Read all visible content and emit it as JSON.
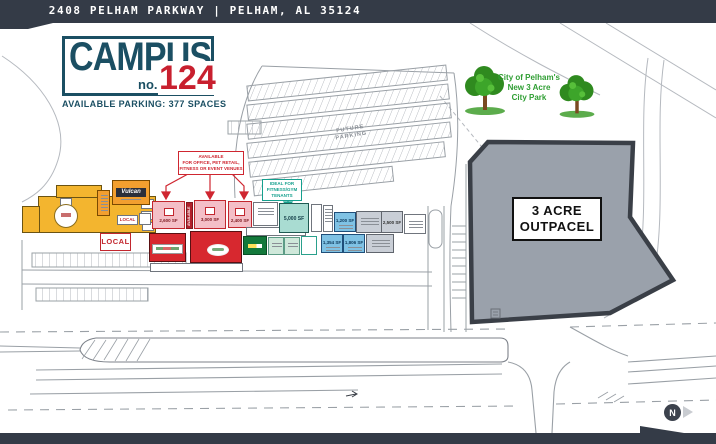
{
  "banner": {
    "address": "2408 PELHAM PARKWAY | PELHAM, AL 35124"
  },
  "logo": {
    "name": "CAMPUS",
    "no_label": "no.",
    "number": "124",
    "tagline": "AVAILABLE PARKING: 377 SPACES"
  },
  "park": {
    "lines": [
      "City of Pelham's",
      "New 3 Acre",
      "City Park"
    ]
  },
  "outparcel": {
    "lines": [
      "3 ACRE",
      "OUTPACEL"
    ]
  },
  "parking": {
    "future_label": [
      "FUTURE",
      "PARKING"
    ]
  },
  "callout_available": {
    "lines": [
      "AVAILABLE",
      "FOR OFFICE, PET RETAIL,",
      "FITNESS OR EVENT VENUES"
    ]
  },
  "callout_fitness": {
    "lines": [
      "IDEAL FOR",
      "FITNESS/GYM",
      "TENANTS"
    ]
  },
  "suites": {
    "vulcan": "Vulcan",
    "local_small": "LOCAL",
    "local_large": "LOCAL",
    "available_vertical": "AVAILABLE",
    "pink": [
      {
        "sf": "2,600 SF"
      },
      {
        "sf": "3,000 SF"
      },
      {
        "sf": "2,400 SF"
      }
    ],
    "gym": "5,000 SF",
    "blue": [
      {
        "sf": "1,200 SF"
      },
      {
        "sf": "1,354 SF"
      },
      {
        "sf": "1,806 SF"
      }
    ],
    "gray_label": "2,500 SF"
  },
  "compass": {
    "north": "N"
  },
  "colors": {
    "banner_dark": "#343b47",
    "logo_teal": "#1b4f63",
    "logo_red": "#c8202f",
    "park_green": "#2f9e33",
    "outparcel_fill": "#9aa1ab",
    "outparcel_border": "#3a3f47",
    "available_red": "#cf2630",
    "fitness_teal": "#15a08e",
    "building_yellow": "#f3b52f",
    "building_pink": "#f4bfc7",
    "building_red": "#d7282f",
    "building_blue": "#7fc2e4",
    "building_teal": "#a9dcd2"
  }
}
